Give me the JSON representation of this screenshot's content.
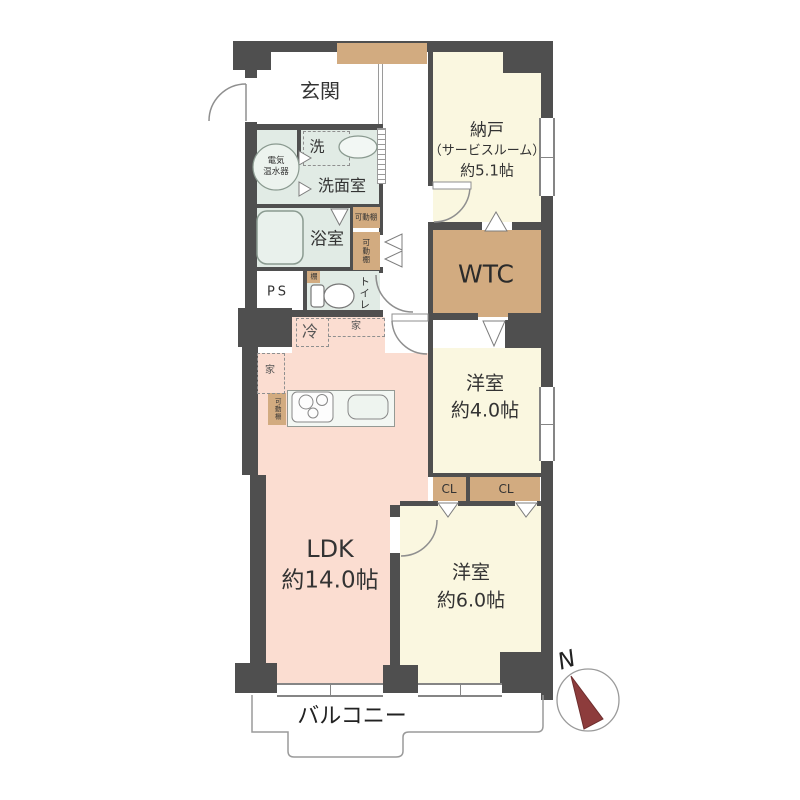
{
  "plan": {
    "entrance": {
      "label": "玄関"
    },
    "storage_room": {
      "name": "納戸",
      "sub": "（サービスルーム）",
      "size": "約5.1帖"
    },
    "washroom": {
      "label": "洗面室",
      "washer": "洗"
    },
    "water_heater": {
      "line1": "電気",
      "line2": "温水器"
    },
    "bathroom": {
      "label": "浴室"
    },
    "movable_shelf_top": {
      "label": "可動棚"
    },
    "movable_shelf_side": {
      "label": "可動棚"
    },
    "movable_shelf_kitchen": {
      "label": "可動棚"
    },
    "small_shelf": {
      "label": "棚"
    },
    "pipe_space": {
      "label": "PS"
    },
    "toilet": {
      "label": "トイレ"
    },
    "walkthrough_closet": {
      "label": "WTC"
    },
    "western_room_4": {
      "name": "洋室",
      "size": "約4.0帖"
    },
    "closet_left": {
      "label": "CL"
    },
    "closet_right": {
      "label": "CL"
    },
    "western_room_6": {
      "name": "洋室",
      "size": "約6.0帖"
    },
    "ldk": {
      "name": "LDK",
      "size": "約14.0帖"
    },
    "refrigerator": {
      "label": "冷"
    },
    "furniture_top": {
      "label": "家"
    },
    "furniture_side": {
      "label": "家"
    },
    "balcony": {
      "label": "バルコニー"
    },
    "compass": {
      "label": "N"
    }
  },
  "colors": {
    "wall": "#4f4f4f",
    "room_cream": "#faf7e0",
    "room_mint": "#e1ebe5",
    "room_pink": "#fbddd1",
    "closet_tan": "#d2ab80",
    "compass_needle": "#8d3c3c"
  }
}
